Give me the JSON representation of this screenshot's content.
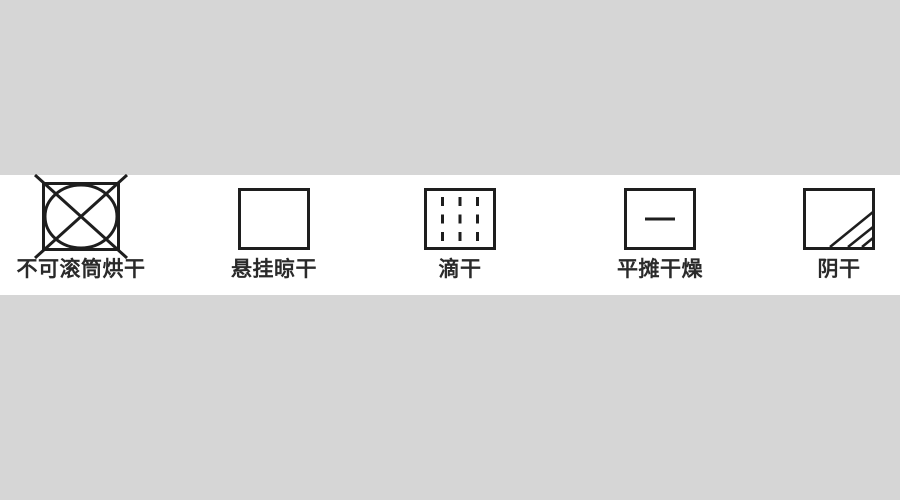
{
  "page": {
    "background_color": "#d6d6d6",
    "band_color": "#ffffff",
    "symbol_stroke_color": "#1e1e1e",
    "label_color": "#2a2a2a"
  },
  "items": [
    {
      "label": "不可滚筒烘干",
      "symbol": "do-not-tumble-dry-icon"
    },
    {
      "label": "悬挂晾干",
      "symbol": "hang-to-dry-icon"
    },
    {
      "label": "滴干",
      "symbol": "drip-dry-icon"
    },
    {
      "label": "平摊干燥",
      "symbol": "dry-flat-icon"
    },
    {
      "label": "阴干",
      "symbol": "dry-in-shade-icon"
    }
  ]
}
